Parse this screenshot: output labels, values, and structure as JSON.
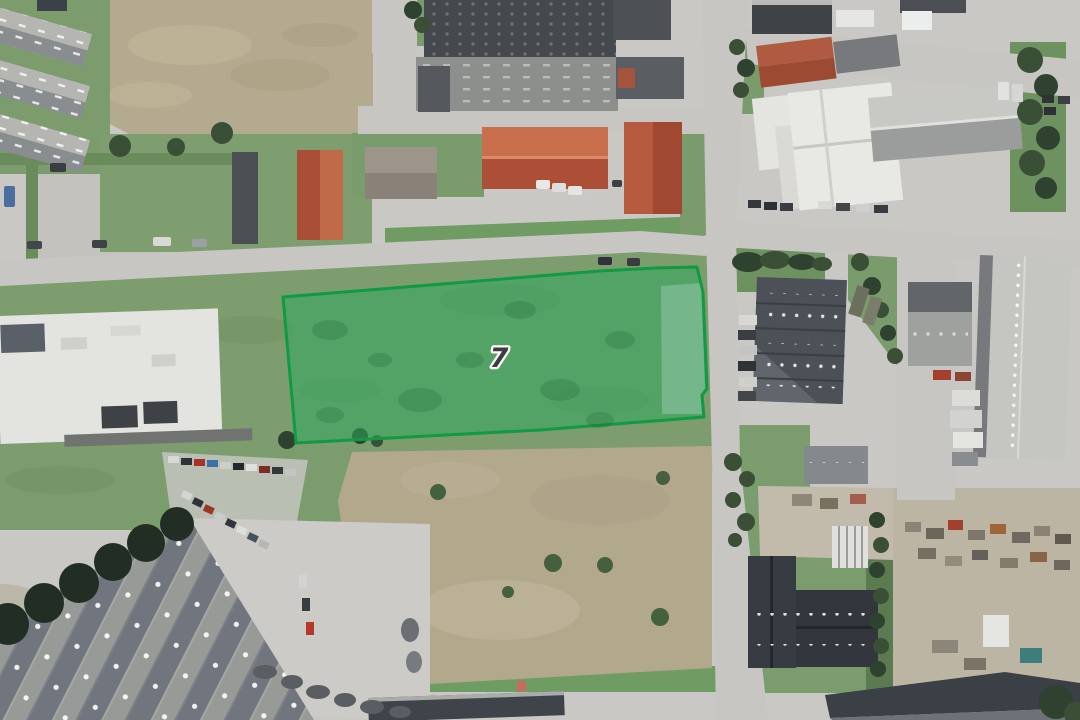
{
  "parcel": {
    "label": "7",
    "fill_color": "#2fa75c",
    "stroke_color": "#0f9a43",
    "label_color": "#3d3d3d",
    "label_halo_color": "#ffffff"
  }
}
